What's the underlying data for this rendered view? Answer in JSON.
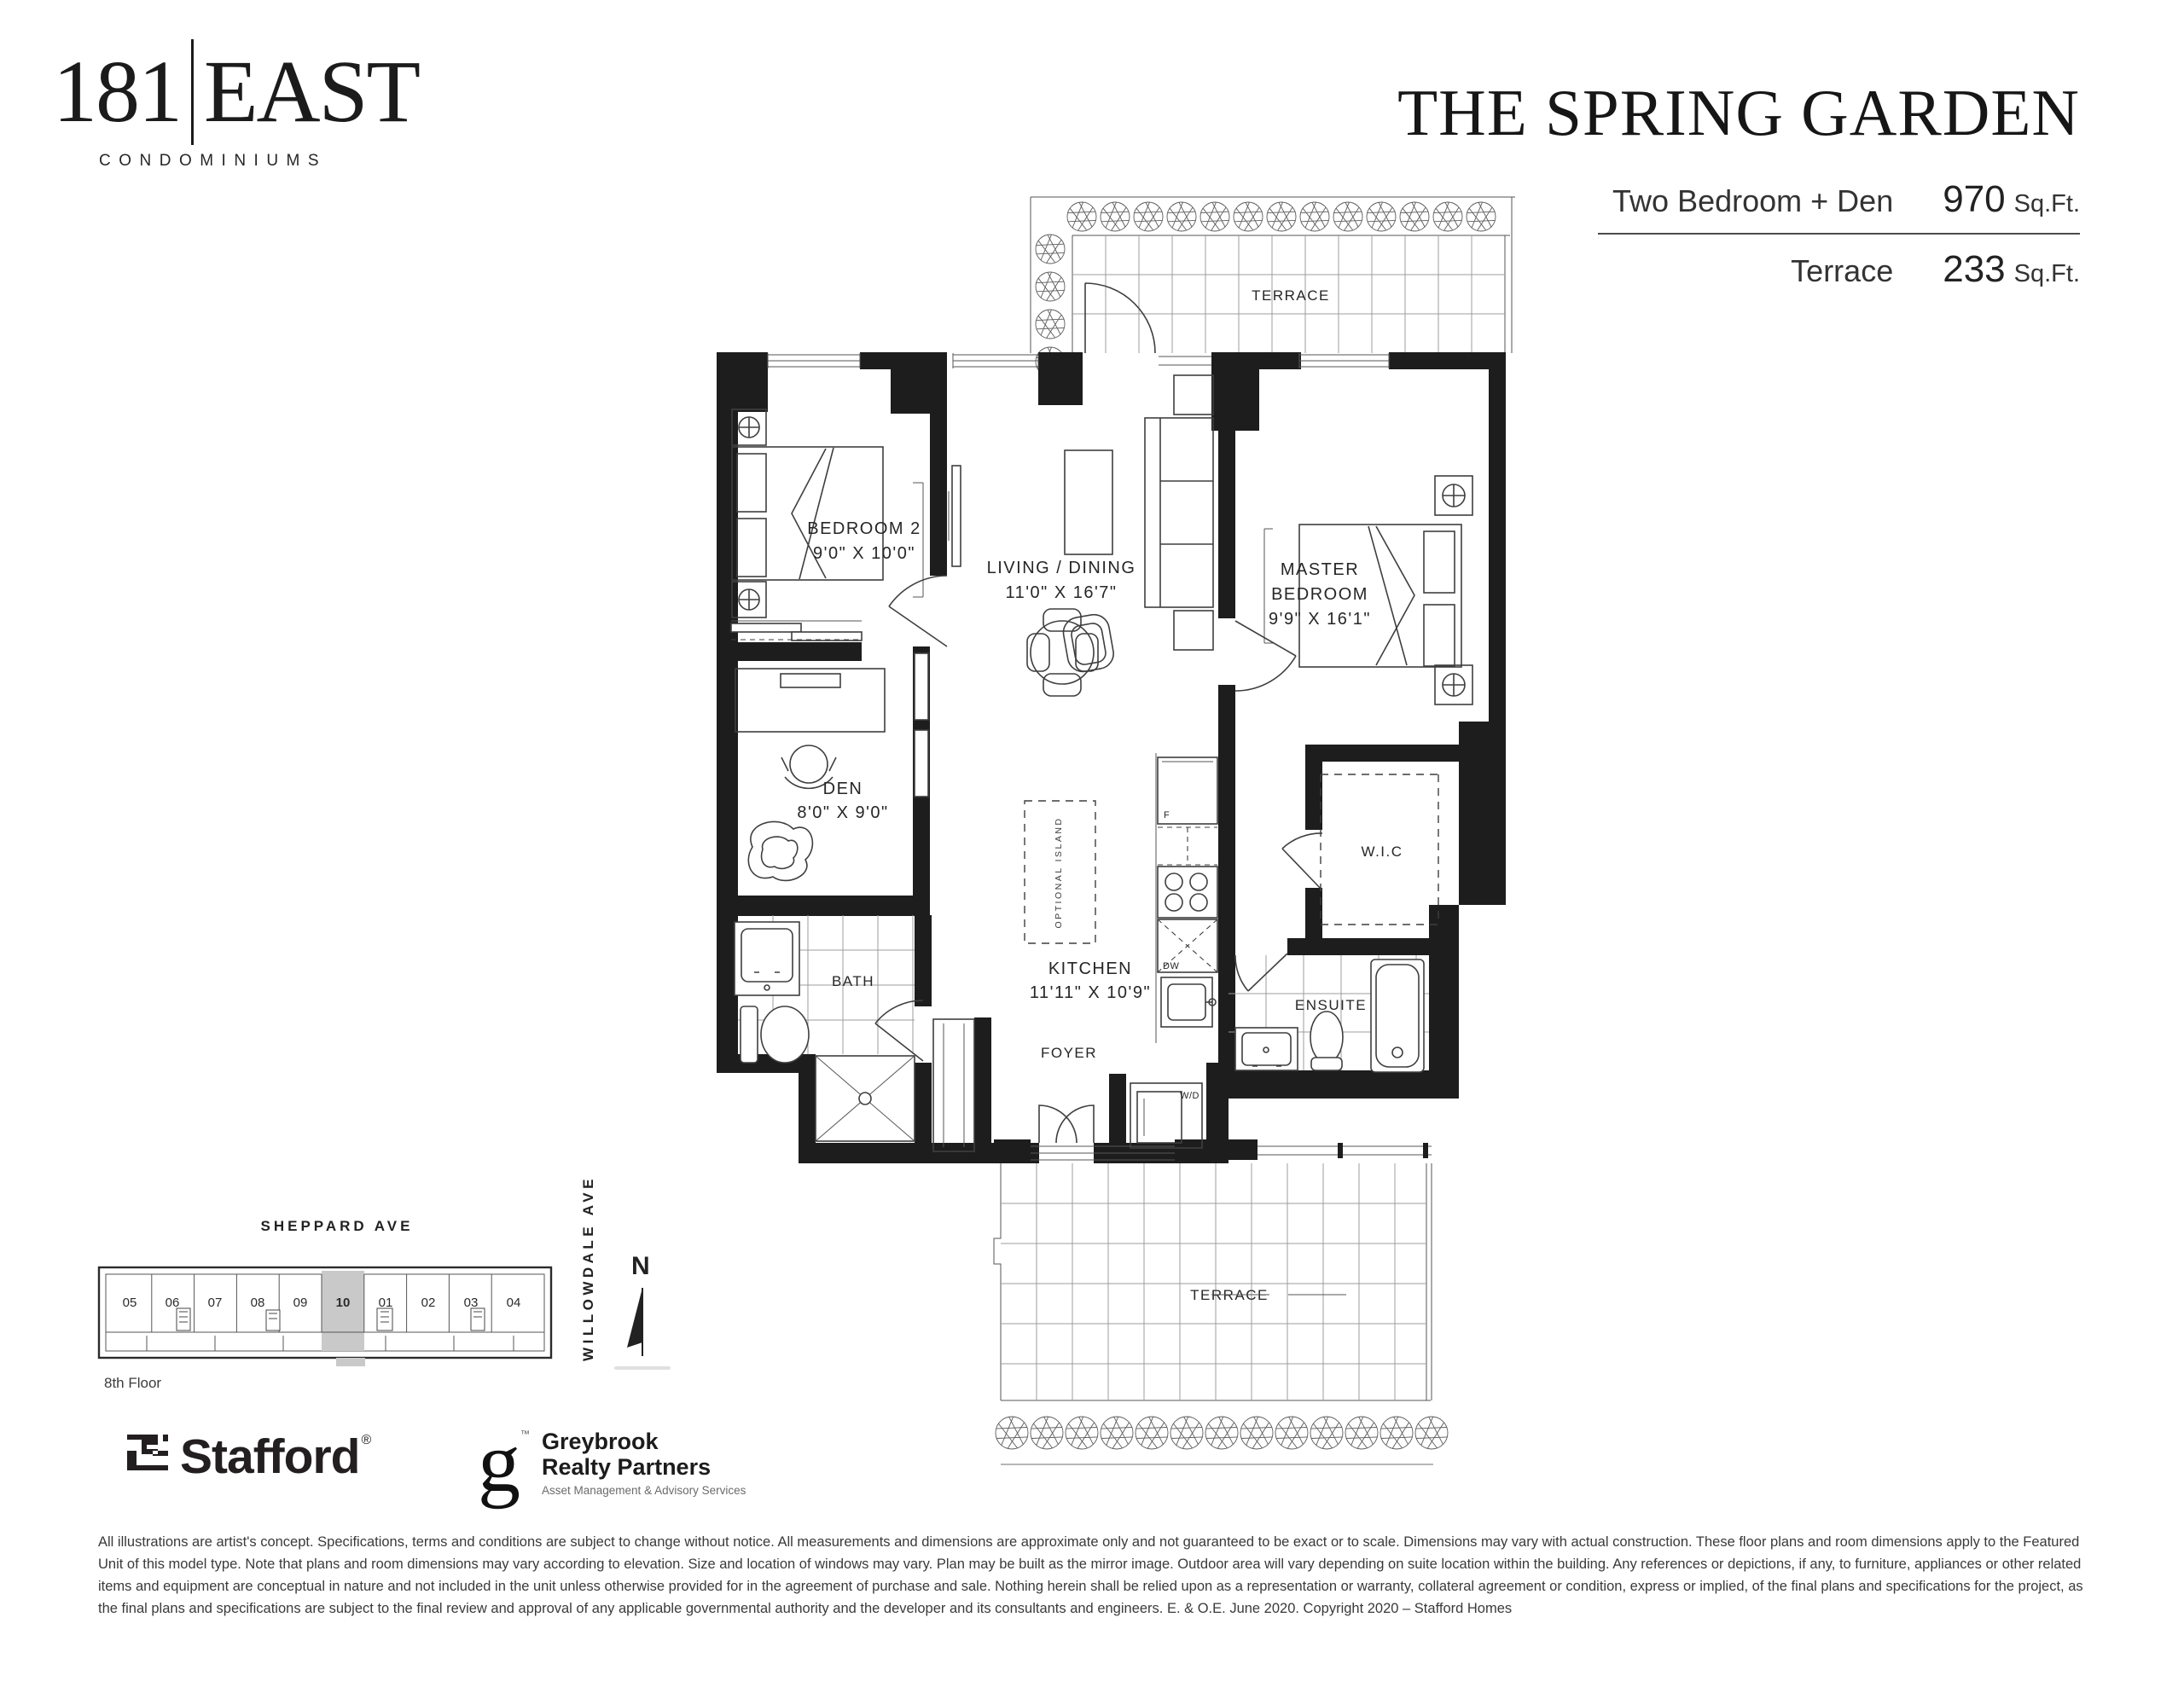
{
  "header": {
    "logo": {
      "number": "181",
      "word": "EAST",
      "subtitle": "CONDOMINIUMS"
    },
    "title": "THE SPRING GARDEN",
    "specs": [
      {
        "label": "Two Bedroom + Den",
        "value": "970",
        "unit": "Sq.Ft."
      },
      {
        "label": "Terrace",
        "value": "233",
        "unit": "Sq.Ft."
      }
    ]
  },
  "plan": {
    "rooms": {
      "terrace_top": "TERRACE",
      "bedroom2_name": "BEDROOM 2",
      "bedroom2_dims": "9'0\" X 10'0\"",
      "living_name": "LIVING / DINING",
      "living_dims": "11'0\" X 16'7\"",
      "master_line1": "MASTER",
      "master_line2": "BEDROOM",
      "master_dims": "9'9\" X 16'1\"",
      "den_name": "DEN",
      "den_dims": "8'0\" X 9'0\"",
      "kitchen_name": "KITCHEN",
      "kitchen_dims": "11'11\" X 10'9\"",
      "bath": "BATH",
      "foyer": "FOYER",
      "wic": "W.I.C",
      "ensuite": "ENSUITE",
      "terrace_bottom": "TERRACE"
    },
    "fixtures": {
      "fridge": "F",
      "dishwasher": "DW",
      "washer_dryer": "W/D",
      "optional_island": "OPTIONAL ISLAND"
    }
  },
  "keyplan": {
    "street_top": "SHEPPARD AVE",
    "street_right": "WILLOWDALE AVE",
    "floor_label": "8th Floor",
    "north_label": "N",
    "units": [
      "05",
      "06",
      "07",
      "08",
      "09",
      "10",
      "01",
      "02",
      "03",
      "04"
    ],
    "highlighted_unit": "10"
  },
  "footer": {
    "stafford_name": "Stafford",
    "stafford_reg": "®",
    "greybrook_monogram": "g",
    "greybrook_tm": "™",
    "greybrook_line1": "Greybrook",
    "greybrook_line2": "Realty Partners",
    "greybrook_tagline": "Asset Management & Advisory Services",
    "disclaimer": "All illustrations are artist's concept. Specifications, terms and conditions are subject to change without notice. All measurements and dimensions are approximate only and not guaranteed to be exact or to scale. Dimensions may vary with actual construction. These floor plans and room dimensions apply to the Featured Unit of this model type. Note that plans and room dimensions may vary according to elevation. Size and location of windows may vary. Plan may be built as the mirror image. Outdoor area will vary depending on suite location within the building. Any references or depictions, if any, to furniture, appliances or other related items and equipment are conceptual in nature and not included in the unit unless otherwise provided for in the agreement of purchase and sale. Nothing herein shall be relied upon as a representation or warranty, collateral agreement or condition, express or implied, of the final plans and specifications for the project, as the final plans and specifications are subject to the final review and approval of any applicable governmental authority and the developer and its consultants and engineers. E. & O.E. June 2020. Copyright 2020 – Stafford Homes"
  },
  "colors": {
    "ink": "#1d1d1d",
    "highlight": "#c9c9c9"
  }
}
